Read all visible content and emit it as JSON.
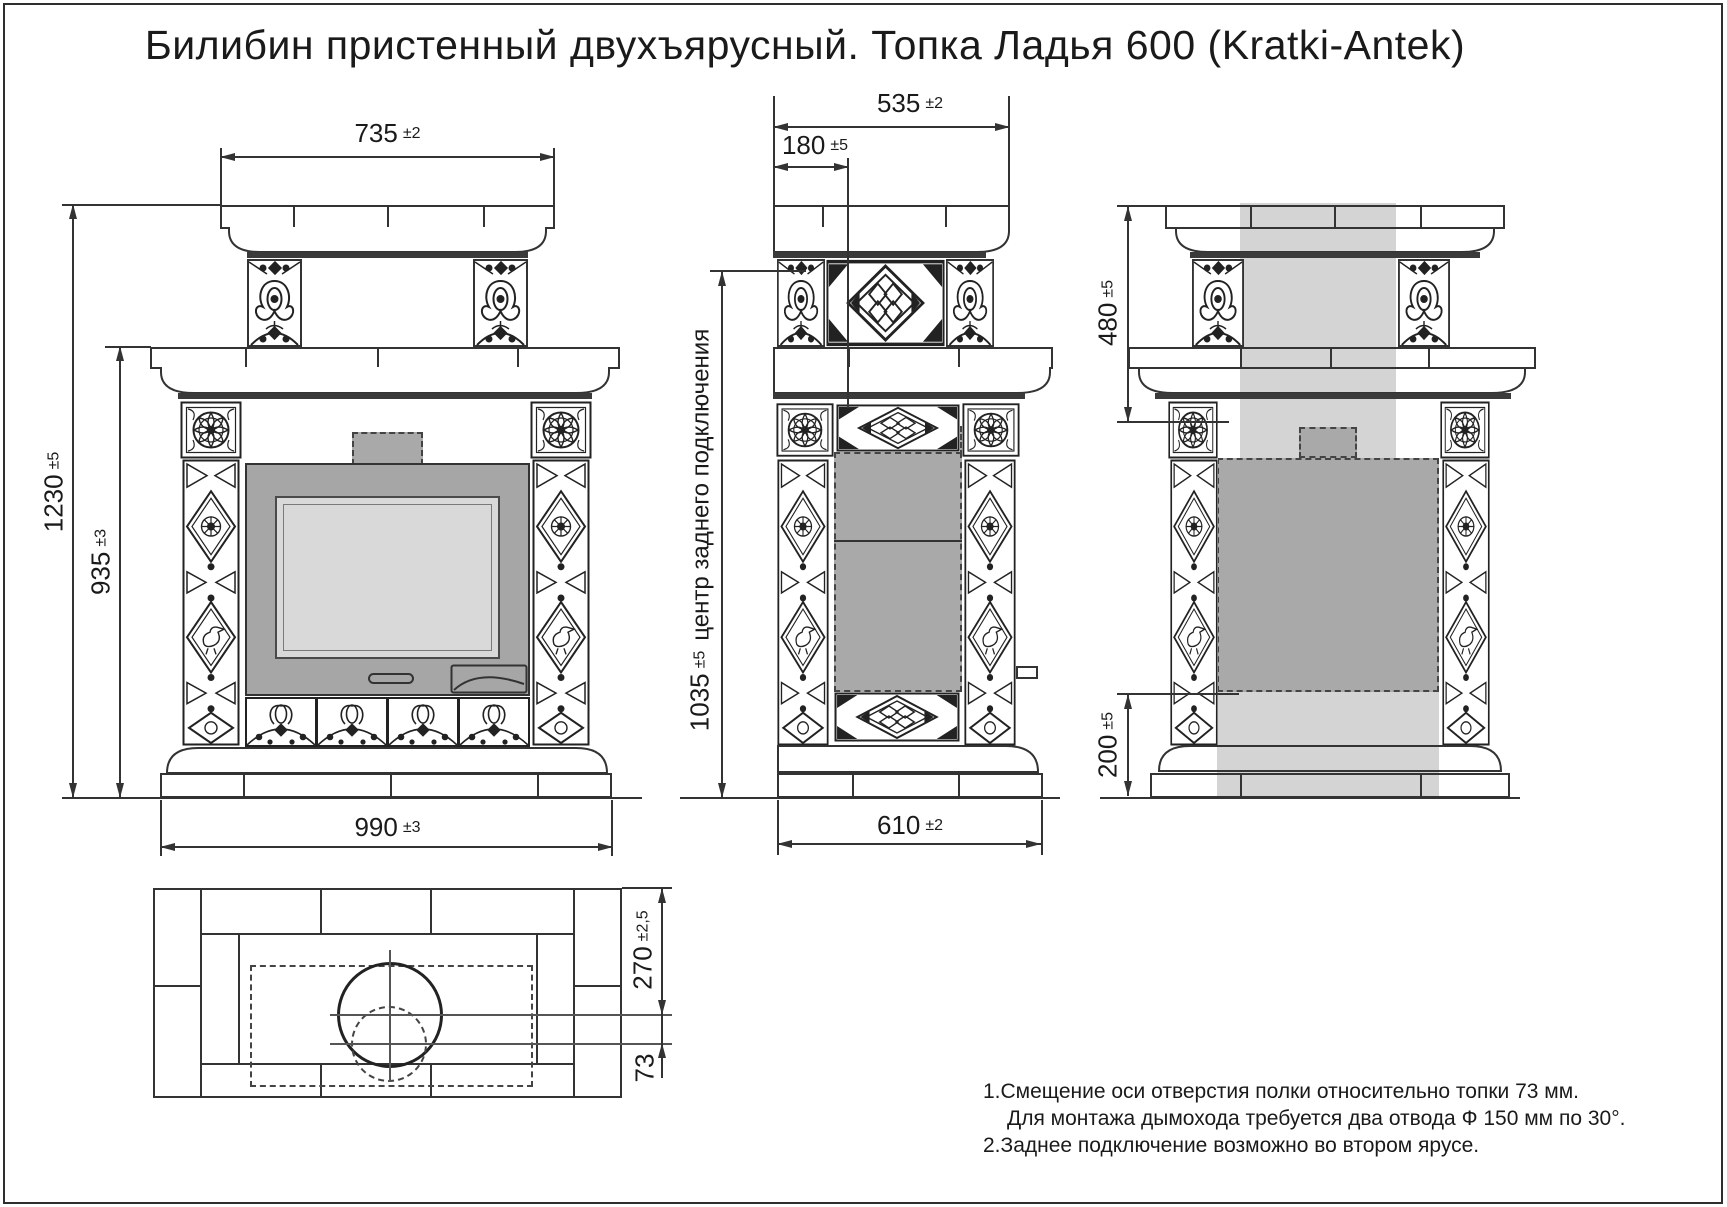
{
  "title": "Билибин пристенный двухъярусный. Топка Ладья 600 (Kratki-Antek)",
  "dimensions": {
    "front_top_width": {
      "value": "735",
      "tolerance": "±2"
    },
    "front_total_height": {
      "value": "1230",
      "tolerance": "±5"
    },
    "front_body_height": {
      "value": "935",
      "tolerance": "±3"
    },
    "front_base_width": {
      "value": "990",
      "tolerance": "±3"
    },
    "side_top_depth": {
      "value": "535",
      "tolerance": "±2"
    },
    "side_front_offset": {
      "value": "180",
      "tolerance": "±5"
    },
    "side_rear_connection": {
      "value": "1035",
      "tolerance": "±5",
      "note": "центр заднего подключения"
    },
    "side_base_depth": {
      "value": "610",
      "tolerance": "±2"
    },
    "back_upper_height": {
      "value": "480",
      "tolerance": "±5"
    },
    "back_lower_height": {
      "value": "200",
      "tolerance": "±5"
    },
    "plan_hole_offset": {
      "value": "270",
      "tolerance": "±2,5"
    },
    "plan_axis_shift": {
      "value": "73",
      "tolerance": ""
    }
  },
  "notes": {
    "line1": "1.Смещение оси отверстия полки относительно топки 73 мм.",
    "line2": "Для монтажа дымохода требуется два отвода Ф 150 мм по 30°.",
    "line3": "2.Заднее подключение возможно во втором ярусе."
  },
  "colors": {
    "line": "#333333",
    "light_shade": "#d4d4d4",
    "mid_shade": "#a9a9a9",
    "firebox_frame": "#a6a6a6",
    "glass": "#d9d9d9"
  }
}
